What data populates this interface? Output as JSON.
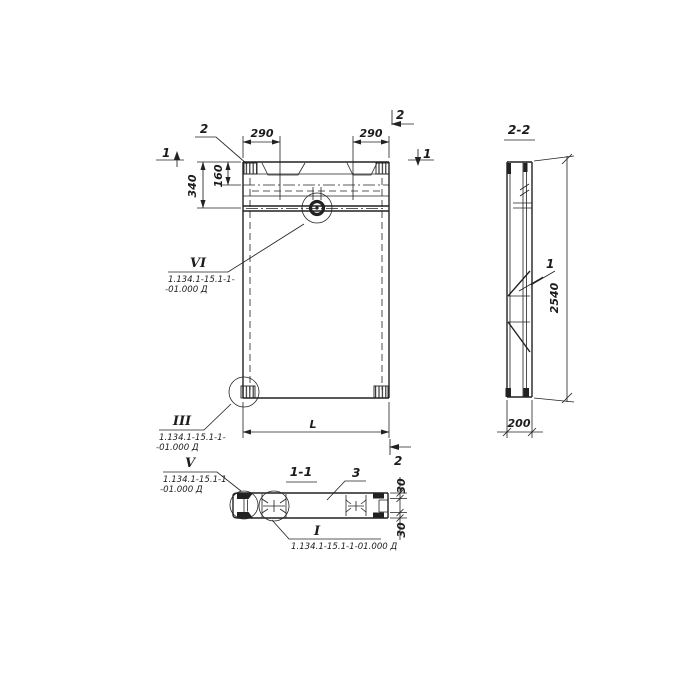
{
  "colors": {
    "ink": "#222222",
    "paper": "#ffffff"
  },
  "front_view": {
    "callout_top_left": "2",
    "section_mark_top_right": "2",
    "section_mark_bottom_right": "2",
    "section_mark_left": "1",
    "section_mark_right": "1",
    "dim_notch_left": "290",
    "dim_notch_right": "290",
    "dim_top_offset": "160",
    "dim_head_height": "340",
    "dim_length": "L"
  },
  "side_view": {
    "title": "2-2",
    "dim_height": "2540",
    "dim_thickness": "200",
    "callout_rib": "1"
  },
  "section_view": {
    "title": "1-1",
    "callout_panel": "3",
    "dim_flange_top": "30",
    "dim_flange_bottom": "30"
  },
  "detail_callouts": {
    "vi": {
      "numeral": "VI",
      "doc_line1": "1.134.1-15.1-1-",
      "doc_line2": "-01.000 Д"
    },
    "iii": {
      "numeral": "III",
      "doc_line1": "1.134.1-15.1-1-",
      "doc_line2": "-01.000 Д"
    },
    "v": {
      "numeral": "V",
      "doc_line1": "1.134.1-15.1-1",
      "doc_line2": "-01.000 Д"
    },
    "i": {
      "numeral": "I",
      "doc_line": "1.134.1-15.1-1-01.000 Д"
    }
  }
}
